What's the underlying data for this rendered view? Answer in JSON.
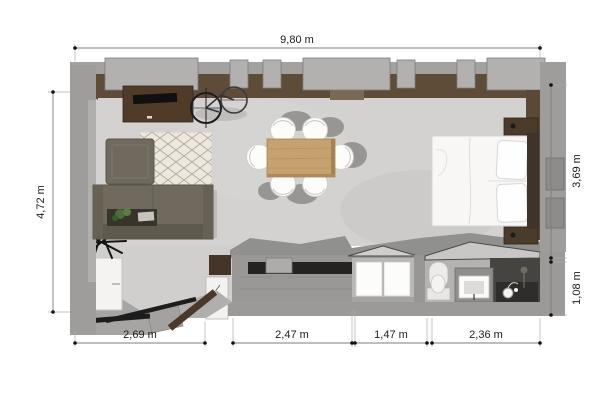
{
  "plan": {
    "type": "3d-floor-plan-top-view",
    "dimensions": {
      "top_width": "9,80 m",
      "left_height": "4,72 m",
      "right_upper": "3,69 m",
      "right_lower": "1,08 m",
      "bottom_segment_1": "2,69 m",
      "bottom_segment_2": "2,47 m",
      "bottom_segment_3": "1,47 m",
      "bottom_segment_4": "2,36 m"
    },
    "rooms": [
      "living-dining-room",
      "sleeping-area",
      "kitchen",
      "bathroom",
      "entry"
    ],
    "furniture": [
      "tv-console",
      "tv",
      "bicycle",
      "armchair",
      "rug",
      "sofa",
      "coffee-table-with-plant",
      "dining-table",
      "dining-chairs",
      "bed",
      "pillows",
      "nightstands",
      "wardrobe",
      "entry-door",
      "doormat",
      "floor-plant",
      "kitchen-counter",
      "kitchen-sink",
      "kitchen-window",
      "toilet",
      "bathroom-vanity",
      "shower-head",
      "radiators"
    ],
    "colors": {
      "background": "#ffffff",
      "floor": "#d3d2d0",
      "wall_gray": "#9e9d9b",
      "wall_block_gray": "#b2b1af",
      "wall_trim_brown": "#5e4c39",
      "wood_dark": "#4a3828",
      "wood_table": "#c7a271",
      "sofa_olive": "#6f6a5d",
      "white_furniture": "#f7f6f5",
      "shower_dark": "#454441",
      "dimension_line": "#9a9a9a",
      "dimension_text": "#1c1c1c"
    }
  }
}
